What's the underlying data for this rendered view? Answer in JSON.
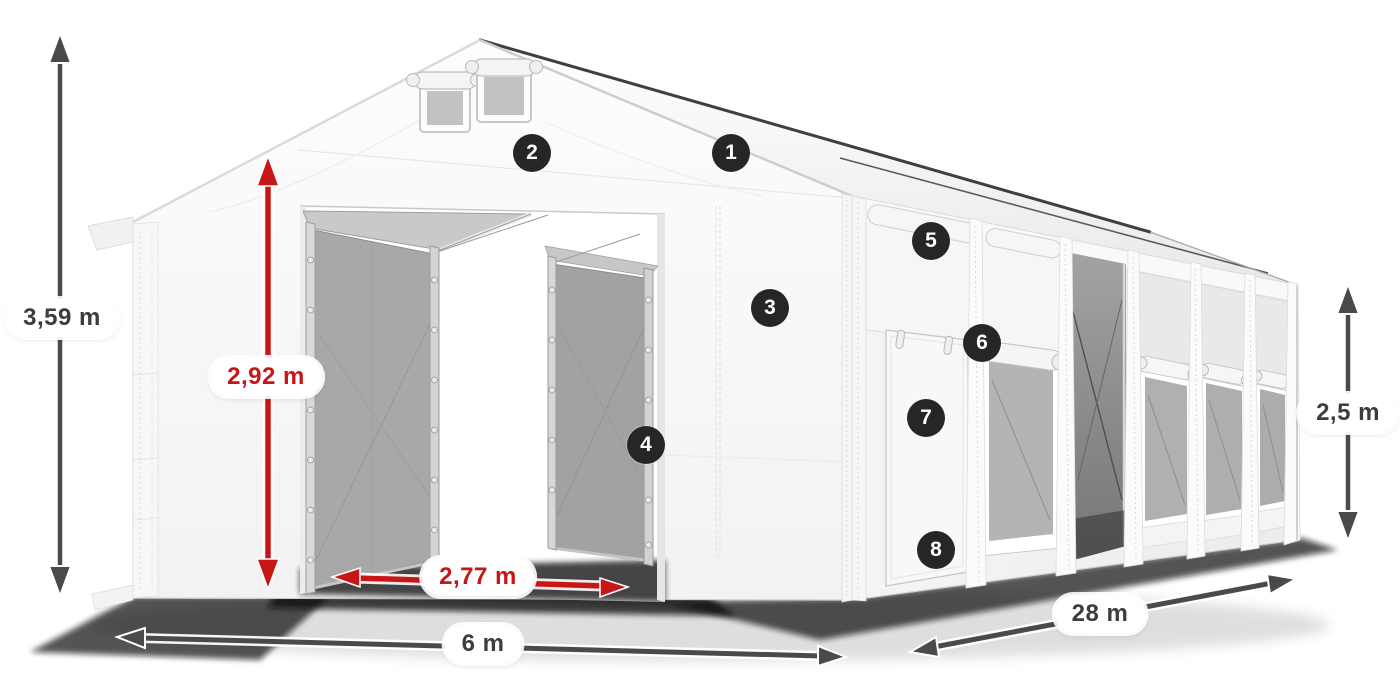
{
  "page": {
    "title": "Storage tent dimensions diagram",
    "background": "#ffffff",
    "subject": "white storage tent with mesh gates, side door and mosquito-net windows"
  },
  "colors": {
    "accent_red": "#c81515",
    "dimension_arrow_gray": "#4a4a4a",
    "label_text": "#3d3d3d",
    "marker_background": "#262626",
    "marker_text": "#ffffff",
    "tent_white": "#f7f7f7",
    "mesh_gray": "#a8a8a8"
  },
  "dimensions": {
    "total_height": {
      "label": "3,59 m",
      "style": "gray"
    },
    "entrance_height": {
      "label": "2,92 m",
      "style": "red"
    },
    "entrance_width": {
      "label": "2,77 m",
      "style": "red"
    },
    "front_width": {
      "label": "6 m",
      "style": "gray"
    },
    "length": {
      "label": "28 m",
      "style": "gray"
    },
    "side_height": {
      "label": "2,5 m",
      "style": "gray"
    }
  },
  "markers": [
    {
      "number": "1"
    },
    {
      "number": "2"
    },
    {
      "number": "3"
    },
    {
      "number": "4"
    },
    {
      "number": "5"
    },
    {
      "number": "6"
    },
    {
      "number": "7"
    },
    {
      "number": "8"
    }
  ]
}
